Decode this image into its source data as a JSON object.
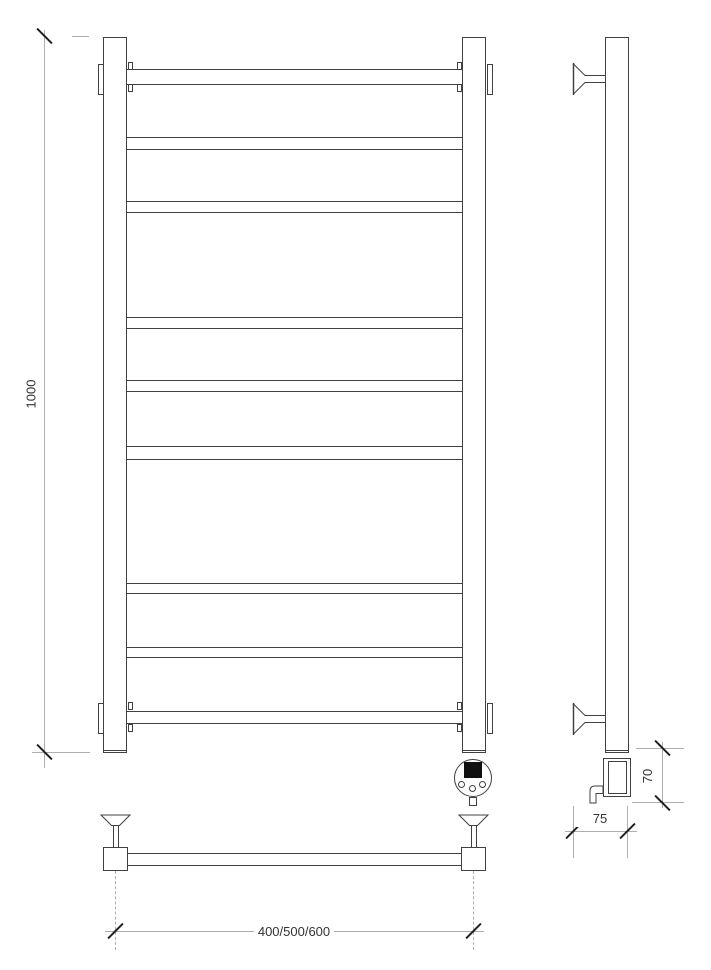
{
  "drawing": {
    "dimensions": {
      "overall_height": "1000",
      "width_options": "400/500/600",
      "element_height": "70",
      "bracket_depth": "75"
    },
    "colors": {
      "background": "#ffffff",
      "object_line": "#414141",
      "dimension_line": "#aeaeae",
      "tick": "#1f1f1f",
      "text": "#333333"
    }
  }
}
